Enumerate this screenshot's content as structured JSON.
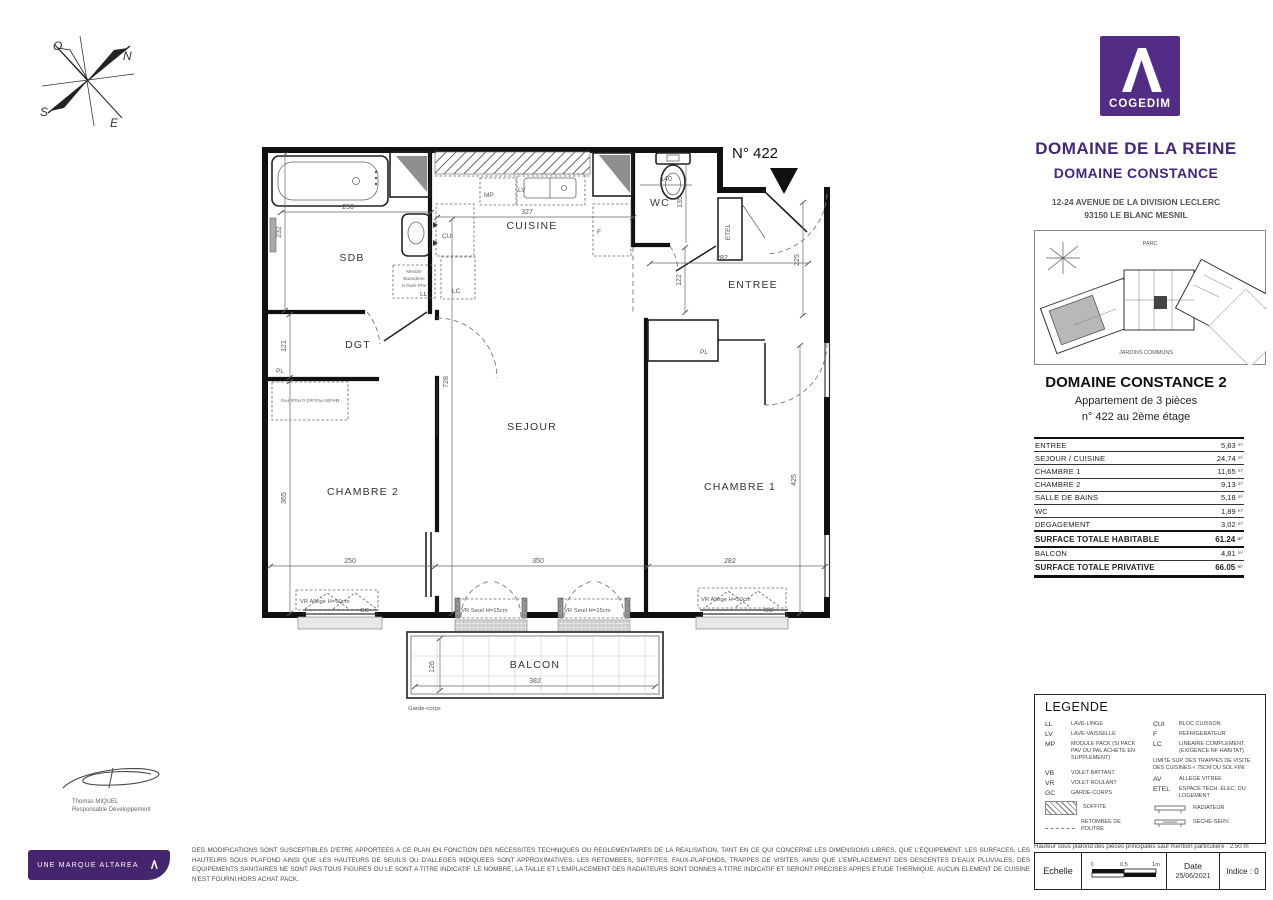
{
  "brand": {
    "logo_word": "COGEDIM",
    "purple": "#532c85"
  },
  "project": {
    "title": "DOMAINE DE LA REINE",
    "subtitle": "DOMAINE CONSTANCE",
    "address_line1": "12-24 AVENUE DE LA DIVISION LECLERC",
    "address_line2": "93150 LE BLANC MESNIL"
  },
  "site_plan": {
    "label_top": "PARC",
    "label_bottom": "JARDINS COMMUNS"
  },
  "unit": {
    "residence": "DOMAINE CONSTANCE 2",
    "type": "Appartement de 3 pièces",
    "location": "n° 422 au 2ème étage",
    "number": "N° 422"
  },
  "areas": {
    "unit_suffix": "m²",
    "rows": [
      {
        "label": "ENTREE",
        "value": "5,63"
      },
      {
        "label": "SEJOUR / CUISINE",
        "value": "24,74"
      },
      {
        "label": "CHAMBRE 1",
        "value": "11,65"
      },
      {
        "label": "CHAMBRE 2",
        "value": "9,13"
      },
      {
        "label": "SALLE DE BAINS",
        "value": "5,18"
      },
      {
        "label": "WC",
        "value": "1,89"
      },
      {
        "label": "DEGAGEMENT",
        "value": "3,02"
      },
      {
        "label": "SURFACE TOTALE HABITABLE",
        "value": "61.24"
      },
      {
        "label": "BALCON",
        "value": "4,81"
      },
      {
        "label": "SURFACE TOTALE PRIVATIVE",
        "value": "66.05"
      }
    ]
  },
  "plan": {
    "rooms": {
      "sdb": "SDB",
      "dgt": "DGT",
      "chambre2": "CHAMBRE 2",
      "sejour": "SEJOUR",
      "cuisine": "CUISINE",
      "wc": "WC",
      "entree": "ENTREE",
      "chambre1": "CHAMBRE 1",
      "balcon": "BALCON"
    },
    "dims": {
      "tub": "250",
      "sdb_left": "232",
      "cuisine": "327",
      "wc_w": "140",
      "wc_h": "135",
      "entree_w": "282",
      "entree_h": "225",
      "hall": "122",
      "dgt": "121",
      "sejour_h": "728",
      "ch2_h": "365",
      "ch1_h": "425",
      "ch2_w": "250",
      "sejour_w": "350",
      "ch1_w": "282",
      "balcon_d": "126",
      "balcon_w": "382"
    },
    "fixtures": {
      "mp": "MP",
      "lv": "LV",
      "cui": "CUI",
      "lc": "LC",
      "f": "F",
      "ll": "LL",
      "etel": "ETEL",
      "pl_dgt": "PL",
      "pl_ch1": "PL",
      "meuble_buanderie_1": "Meuble",
      "meuble_buanderie_2": "Buanderie",
      "meuble_buanderie_3": "si Pack PAV",
      "meuble_placard": "Meuble Placard si Pack PAV"
    },
    "windows": {
      "ch2": "VR Allège H=50cm",
      "sejour1": "VR Seuil H=15cm",
      "sejour2": "VR Seuil H=15cm",
      "ch1": "VR Allège H=50cm",
      "gc1": "GC",
      "gc2": "GC"
    },
    "garde_corps": "Garde-corps",
    "compass": {
      "n": "N",
      "s": "S",
      "e": "E",
      "o": "O"
    }
  },
  "legend": {
    "title": "LEGENDE",
    "col1": [
      {
        "abbr": "LL",
        "text": "LAVE-LINGE"
      },
      {
        "abbr": "LV",
        "text": "LAVE-VAISSELLE"
      },
      {
        "abbr": "MP",
        "text": "MODULE PACK (SI PACK PAV OU PAL ACHETE EN SUPPLEMENT)"
      },
      {
        "abbr": "VB",
        "text": "VOLET BATTANT"
      },
      {
        "abbr": "VR",
        "text": "VOLET ROULANT"
      },
      {
        "abbr": "GC",
        "text": "GARDE-CORPS"
      }
    ],
    "col1_symbols": [
      {
        "icon": "soffite",
        "text": "SOFFITE"
      },
      {
        "icon": "beam",
        "text": "RETOMBEE DE POUTRE"
      }
    ],
    "col2": [
      {
        "abbr": "CUI",
        "text": "BLOC CUISSON"
      },
      {
        "abbr": "F",
        "text": "REFRIGERATEUR"
      },
      {
        "abbr": "LC",
        "text": "LINEAIRE COMPLEMENT. (EXIGENCE NF HABITAT)"
      }
    ],
    "col2_note": "LIMITE SUP. DES TRAPPES DE VISITE DES CUISINES < 75CM DU SOL FINI",
    "col2b": [
      {
        "abbr": "AV",
        "text": "ALLEGE VITREE"
      },
      {
        "abbr": "ETEL",
        "text": "ESPACE TECH. ELEC. DU LOGEMENT"
      }
    ],
    "col2_symbols": [
      {
        "icon": "radiator",
        "text": "RADIATEUR"
      },
      {
        "icon": "dryer",
        "text": "SECHE-SERV."
      }
    ]
  },
  "notes": {
    "ceiling": "Hauteur sous plafond des pièces principales sauf mention particulière : 2.50 m",
    "disclaimer": "DES MODIFICATIONS SONT SUSCEPTIBLES D'ETRE APPORTEES A CE PLAN EN FONCTION DES NECESSITES TECHNIQUES OU REGLEMENTAIRES DE LA REALISATION, TANT EN CE QUI CONCERNE LES DIMENSIONS LIBRES, QUE L'EQUIPEMENT. LES SURFACES, LES HAUTEURS SOUS PLAFOND AINSI QUE LES HAUTEURS DE SEUILS OU D'ALLEGES INDIQUEES SONT APPROXIMATIVES. LES RETOMBEES, SOFFITES, FAUX-PLAFONDS, TRAPPES DE VISITES, AINSI QUE L'EMPLACEMENT DES DESCENTES D'EAUX PLUVIALES, DES EQUIPEMENTS SANITAIRES NE SONT PAS TOUS FIGURES OU LE SONT A TITRE INDICATIF. LE NOMBRE, LA TAILLE ET L'EMPLACEMENT DES RADIATEURS SONT DONNES A TITRE INDICATIF ET SERONT PRECISES APRES ETUDE THERMIQUE. AUCUN ELEMENT DE CUISINE N'EST FOURNI HORS ACHAT PACK."
  },
  "titleblock": {
    "scale_label": "Echelle",
    "tick0": "0",
    "tick05": "0,5",
    "tick1": "1m",
    "date_label": "Date",
    "date_value": "25/06/2021",
    "index": "Indice : 0"
  },
  "footer": {
    "brand_bar": "UNE MARQUE ALTAREA"
  },
  "signature": {
    "name": "Thomas MIQUEL",
    "role": "Responsable Développement"
  }
}
